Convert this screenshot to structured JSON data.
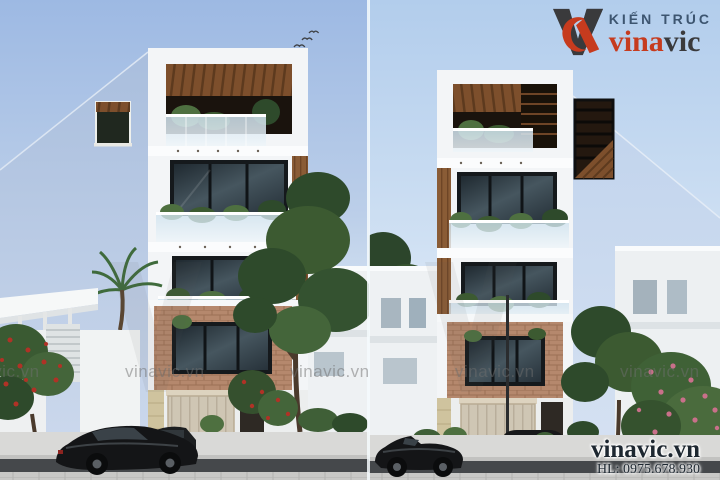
{
  "branding": {
    "tagline": "KIẾN TRÚC",
    "brand_first": "vina",
    "brand_second": "vic",
    "colors": {
      "brand_red": "#c63b1e",
      "brand_dark": "#3a3a3c",
      "tagline_blue": "#3d5570",
      "contact_dark": "#1d2730"
    }
  },
  "watermark": {
    "text": "vinavic.vn"
  },
  "contact": {
    "website": "vinavic.vn",
    "hotline": "HL: 0975.678.930"
  },
  "colors": {
    "watermark_gray": "#6f6f6f",
    "sky_left_top": "#9db9e3",
    "sky_left_bottom": "#edf3fa",
    "sky_right_top": "#b2cdec",
    "sky_right_bottom": "#eff5fb",
    "building_side_wall": "#b7c9e4",
    "facade_white": "#f3f5f7",
    "wood_accent": "#7d4f2c",
    "brick_accent": "#b5886d",
    "window_glass_dark": "#313d44",
    "foliage_dark": "#2e4a2b",
    "foliage_light": "#4e7040",
    "flower_red": "#b03226",
    "flower_pink": "#c9708a",
    "asphalt": "#45484b",
    "pavement": "#d9d9d7",
    "car_black": "#141517"
  }
}
